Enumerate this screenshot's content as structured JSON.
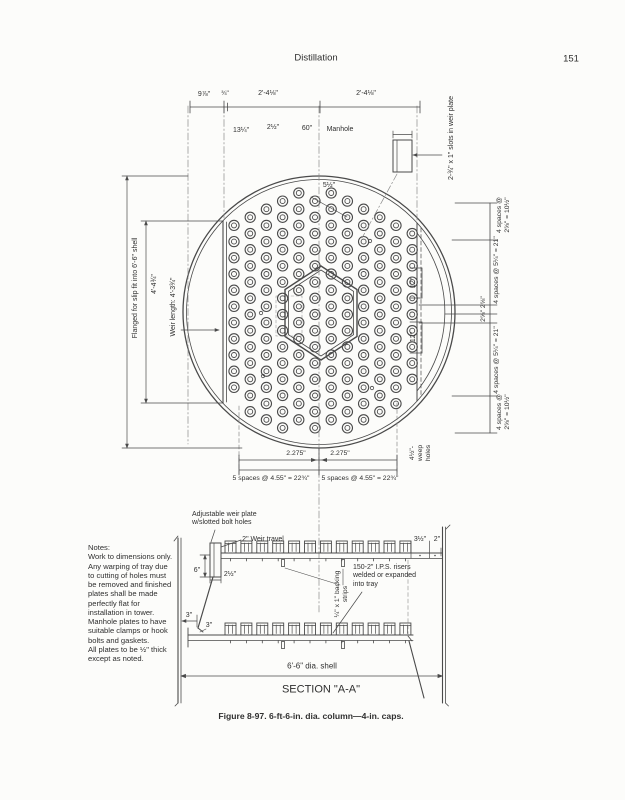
{
  "page": {
    "header_title": "Distillation",
    "page_number": "151",
    "caption": "Figure 8-97. 6-ft-6-in. dia. column—4-in. caps."
  },
  "plan": {
    "top_dims": {
      "d1": "9⅞\"",
      "d2": "¾\"",
      "d3": "2'-4⅛\"",
      "d4": "2'-4⅛\""
    },
    "inner_dims": {
      "d13": "13¼\"",
      "d2half": "2½\"",
      "d60": "60\"",
      "manhole": "Manhole",
      "d5half": "5½\""
    },
    "slots_note": "2-¾\" x 1\" slots in weir plate",
    "left": {
      "flanged": "Flanged for slip fit into 6'-6\" shell",
      "overall": "4'-4¾\"",
      "weir_length": "Weir length: 4'-3¾\""
    },
    "right": {
      "top_small": "4 spaces @\n2⅝\" = 10½\"",
      "top_large": "4 spaces @ 5¼\" = 21\"",
      "middle": "2⅝\"  2⅝\"",
      "bottom_large": "4 spaces @ 5¼\" = 21\"",
      "bottom_small": "4 spaces @\n2⅝\" = 10½\"",
      "twelve_top": "12\"",
      "twelve_bottom": "12\""
    },
    "bottom": {
      "left_half": "2.275\"",
      "right_half": "2.275\"",
      "left_spaces": "5 spaces @ 4.55\" = 22¾\"",
      "right_spaces": "5 spaces @ 4.55\" = 22¾\"",
      "weep": "4½\"-\nweep\nholes"
    }
  },
  "section": {
    "adjustable_weir": "Adjustable weir plate\nw/slotted bolt holes",
    "weir_travel": "2\" Weir travel",
    "dim_6": "6\"",
    "dim_2half": "2½\"",
    "dim_3half": "3½\"",
    "dim_2": "2\"",
    "risers": "150-2\" I.P.S. risers\nwelded or expanded\ninto tray",
    "backing": "¼\" x 1\" backing\nstrips",
    "dim_3a": "3\"",
    "dim_3b": "3\"",
    "shell": "6'-6\" dia. shell",
    "title": "SECTION \"A-A\""
  },
  "notes": {
    "text": "Notes:\nWork to dimensions only.\nAny warping of tray due\nto cutting of holes must\nbe removed and finished\nplates shall be made\nperfectly flat for\ninstallation in tower.\nManhole plates to have\nsuitable clamps or hook\nbolts and gaskets.\nAll plates to be ½\" thick\nexcept as noted."
  },
  "drawing": {
    "plan_caps": {
      "columns": 12,
      "x0": 234,
      "dx": 16.2,
      "x_center": 319,
      "y_center": 312,
      "y0": 193,
      "y1": 440,
      "row_step": 16.2,
      "stagger": 8.1,
      "max_radius": 123.5,
      "cap_r_outer": 5.1,
      "cap_r_inner": 2.5
    },
    "section_caps": {
      "count": 12,
      "x0": 230.5,
      "dx": 15.9,
      "top_y": 541,
      "bottom_y": 623,
      "cap_w": 11,
      "cap_h": 12
    }
  }
}
